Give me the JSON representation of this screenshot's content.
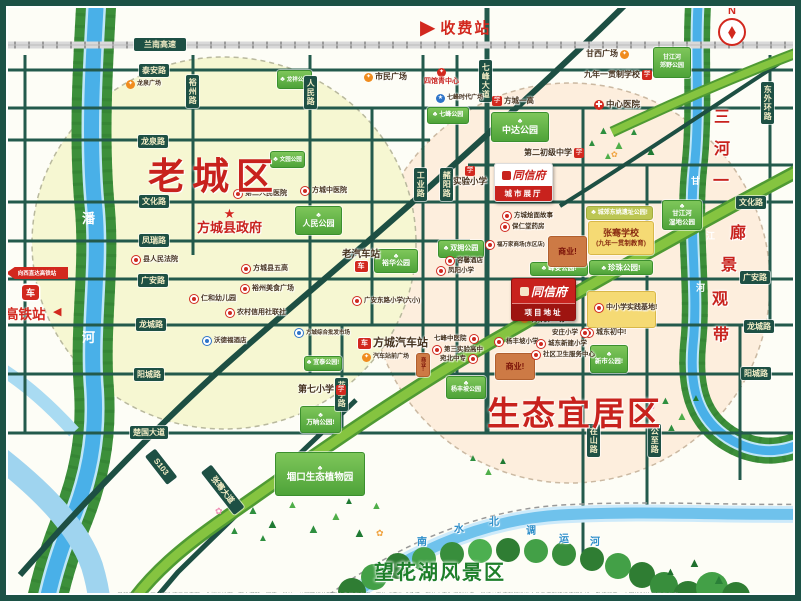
{
  "compass": {
    "label": "N"
  },
  "toll": {
    "label": "收费站"
  },
  "hsr": {
    "banner": "向西直达高铁站",
    "station": "高铁站"
  },
  "zones": {
    "old_town": "老城区",
    "eco": "生态宜居区",
    "scenic": "望花湖风景区"
  },
  "project": {
    "brand": "同信府",
    "showroom": "城市展厅",
    "site": "项目地址"
  },
  "footer": {
    "disclaimer": "温馨提示：本区位图为项目示意图，非标准地图，图中道路、河流、学校、公园等相关配套信息仅供参考，不构成要约或承诺，部分内容为规划信息，最终以政府部门批准文件及实际建设情况为准，敬请留意。本图绘制比例仅供参考。"
  },
  "glyphs": {
    "arrow_right": "▶",
    "arrow_left": "◀",
    "tree": "♣",
    "needle": "◆"
  },
  "icon_glyphs": {
    "school": "学",
    "plaza": "✦",
    "redplaza": "✦",
    "hosp": "✚",
    "bus": "车",
    "blue": "★",
    "train": "车",
    "star": "★",
    "dot": "",
    "bdot": ""
  },
  "road_labels": [
    {
      "id": "lannan-expwy",
      "t": "兰南高速",
      "x": 134,
      "y": 38,
      "w": 46
    },
    {
      "id": "taian-rd",
      "t": "泰安路",
      "x": 139,
      "y": 64
    },
    {
      "id": "longquan-rd",
      "t": "龙泉路",
      "x": 138,
      "y": 135
    },
    {
      "id": "wenhua-rd-l",
      "t": "文化路",
      "x": 139,
      "y": 195
    },
    {
      "id": "fengrui-rd",
      "t": "凤瑞路",
      "x": 139,
      "y": 234
    },
    {
      "id": "guangan-rd-l",
      "t": "广安路",
      "x": 138,
      "y": 274
    },
    {
      "id": "longcheng-rd-l",
      "t": "龙城路",
      "x": 136,
      "y": 318
    },
    {
      "id": "yangcheng-rd-l",
      "t": "阳城路",
      "x": 134,
      "y": 368
    },
    {
      "id": "chuguo-ave",
      "t": "楚国大道",
      "x": 130,
      "y": 426
    },
    {
      "id": "wenhua-rd-r",
      "t": "文化路",
      "x": 736,
      "y": 196
    },
    {
      "id": "guangan-rd-r",
      "t": "广安路",
      "x": 740,
      "y": 271
    },
    {
      "id": "longcheng-rd-r",
      "t": "龙城路",
      "x": 744,
      "y": 320
    },
    {
      "id": "yangcheng-rd-r",
      "t": "阳城路",
      "x": 741,
      "y": 367
    },
    {
      "id": "yuzhou-rd",
      "t": "裕州路",
      "x": 186,
      "y": 75,
      "v": 1
    },
    {
      "id": "renmin-rd",
      "t": "人民路",
      "x": 304,
      "y": 76,
      "v": 1
    },
    {
      "id": "qifeng-ave",
      "t": "七峰大道",
      "x": 479,
      "y": 60,
      "v": 1
    },
    {
      "id": "gongye-rd",
      "t": "工业路",
      "x": 414,
      "y": 168,
      "v": 1
    },
    {
      "id": "zheyang-rd",
      "t": "赭阳路",
      "x": 440,
      "y": 168,
      "v": 1
    },
    {
      "id": "huating-rd",
      "t": "花亭路",
      "x": 335,
      "y": 378,
      "v": 1
    },
    {
      "id": "zaishan-rd",
      "t": "在山路",
      "x": 587,
      "y": 424,
      "v": 1
    },
    {
      "id": "gongzhi-rd",
      "t": "公至路",
      "x": 648,
      "y": 424,
      "v": 1
    },
    {
      "id": "dongwaihuan-rd",
      "t": "东外环路",
      "x": 761,
      "y": 82,
      "v": 1
    },
    {
      "id": "s103",
      "t": "S103",
      "x": 150,
      "y": 446,
      "rot": 52,
      "w": 30
    },
    {
      "id": "zhangqian-ave",
      "t": "张骞大道",
      "x": 206,
      "y": 462,
      "rot": 52,
      "w": 48
    }
  ],
  "parks": [
    {
      "id": "longxiang-park",
      "lines": [
        "龙祥公园"
      ],
      "x": 277,
      "y": 70,
      "w": 33,
      "h": 17,
      "variant": "green",
      "icon": 1,
      "fs": 5.5
    },
    {
      "id": "qifeng-park",
      "lines": [
        "七峰公园"
      ],
      "x": 427,
      "y": 107,
      "w": 40,
      "h": 15,
      "variant": "green",
      "icon": 1,
      "fs": 6
    },
    {
      "id": "wenyuan-park",
      "lines": [
        "文园公园"
      ],
      "x": 270,
      "y": 151,
      "w": 33,
      "h": 15,
      "variant": "green",
      "icon": 1,
      "fs": 5.5
    },
    {
      "id": "renmin-park",
      "lines": [
        "人民公园"
      ],
      "x": 295,
      "y": 206,
      "w": 45,
      "h": 27,
      "variant": "green",
      "icon": 1,
      "icontop": 1,
      "fs": 8
    },
    {
      "id": "zhongda-park",
      "lines": [
        "中达公园"
      ],
      "x": 491,
      "y": 112,
      "w": 56,
      "h": 28,
      "variant": "green",
      "icon": 1,
      "icontop": 1,
      "fs": 9
    },
    {
      "id": "ganjianghe-country-park",
      "lines": [
        "甘江河",
        "郊野公园"
      ],
      "x": 653,
      "y": 47,
      "w": 36,
      "h": 29,
      "variant": "green",
      "fs": 6
    },
    {
      "id": "ganjianghe-wetland-park",
      "lines": [
        "甘江河",
        "湿地公园"
      ],
      "x": 662,
      "y": 200,
      "w": 38,
      "h": 28,
      "variant": "green",
      "icon": 1,
      "icontop": 1,
      "fs": 6.5
    },
    {
      "id": "yuhua-park",
      "lines": [
        "裕华公园"
      ],
      "x": 374,
      "y": 249,
      "w": 42,
      "h": 22,
      "variant": "green",
      "icon": 1,
      "icontop": 1,
      "fs": 7
    },
    {
      "id": "shuangyong-park",
      "lines": [
        "双拥公园"
      ],
      "x": 438,
      "y": 240,
      "w": 44,
      "h": 16,
      "variant": "green",
      "icon": 1,
      "fs": 7
    },
    {
      "id": "fengan-park",
      "lines": [
        "峰安公园!"
      ],
      "x": 530,
      "y": 262,
      "w": 56,
      "h": 12,
      "variant": "green",
      "icon": 1,
      "fs": 6.5
    },
    {
      "id": "zhenzhu-park",
      "lines": [
        "珍珠公园!"
      ],
      "x": 589,
      "y": 260,
      "w": 62,
      "h": 13,
      "variant": "green",
      "icon": 1,
      "fs": 7.5
    },
    {
      "id": "yizhi-park",
      "lines": [
        "城郊东姚遗址公园!"
      ],
      "x": 586,
      "y": 206,
      "w": 65,
      "h": 12,
      "variant": "lime",
      "icon": 1,
      "fs": 6
    },
    {
      "id": "xinshi-park",
      "lines": [
        "新市公园!"
      ],
      "x": 590,
      "y": 345,
      "w": 36,
      "h": 26,
      "variant": "green",
      "icon": 1,
      "icontop": 1,
      "fs": 6.5
    },
    {
      "id": "yitai-park",
      "lines": [
        "宜泰公园!"
      ],
      "x": 304,
      "y": 356,
      "w": 36,
      "h": 13,
      "variant": "green",
      "icon": 1,
      "fs": 6
    },
    {
      "id": "wanshang-park",
      "lines": [
        "万晌公园!"
      ],
      "x": 300,
      "y": 406,
      "w": 39,
      "h": 25,
      "variant": "green",
      "icon": 1,
      "icontop": 1,
      "fs": 6.5
    },
    {
      "id": "gukou-botanical",
      "lines": [
        "堌口生态植物园"
      ],
      "x": 275,
      "y": 452,
      "w": 88,
      "h": 42,
      "variant": "green",
      "icon": 1,
      "icontop": 1,
      "fs": 9.5
    },
    {
      "id": "yangfengpo-park",
      "lines": [
        "杨丰坡公园"
      ],
      "x": 446,
      "y": 376,
      "w": 38,
      "h": 21,
      "variant": "green",
      "icon": 1,
      "icontop": 1,
      "fs": 6
    },
    {
      "id": "zhangqian-school",
      "lines": [
        "张骞学校",
        "(九年一贯制教育)"
      ],
      "x": 588,
      "y": 221,
      "w": 64,
      "h": 32,
      "variant": "yellow",
      "fs": 9,
      "fs2": 6.5
    },
    {
      "id": "practice-base-box",
      "lines": [],
      "x": 587,
      "y": 291,
      "w": 67,
      "h": 35,
      "variant": "yellow"
    },
    {
      "id": "shangye-1",
      "lines": [
        "商业!"
      ],
      "x": 548,
      "y": 236,
      "w": 37,
      "h": 29,
      "variant": "orange",
      "fs": 8
    },
    {
      "id": "shangye-2",
      "lines": [
        "商业!"
      ],
      "x": 495,
      "y": 353,
      "w": 38,
      "h": 25,
      "variant": "orange",
      "fs": 8
    },
    {
      "id": "shangye-3",
      "lines": [
        "商业!"
      ],
      "x": 416,
      "y": 353,
      "w": 12,
      "h": 22,
      "variant": "orange",
      "fs": 5,
      "vert": 1
    }
  ],
  "pois": [
    {
      "id": "longquan-plaza",
      "t": "龙泉广场",
      "type": "plaza",
      "x": 126,
      "y": 80,
      "fs": 6
    },
    {
      "id": "shimin-plaza",
      "t": "市民广场",
      "type": "plaza",
      "x": 364,
      "y": 73,
      "fs": 8
    },
    {
      "id": "ganxi-plaza",
      "t": "甘西广场",
      "type": "plaza",
      "x": 586,
      "y": 50,
      "fs": 8,
      "ip": "r"
    },
    {
      "id": "sports-plaza",
      "t": "体育广场!",
      "type": "plaza",
      "x": 520,
      "y": 314,
      "fs": 8.5
    },
    {
      "id": "bus-front-plaza",
      "t": "汽车站前广场",
      "type": "plaza",
      "x": 362,
      "y": 353,
      "fs": 6
    },
    {
      "id": "qifeng-times-plaza",
      "t": "七峰时代广场",
      "type": "blue",
      "x": 436,
      "y": 94,
      "fs": 6
    },
    {
      "id": "siguanqing-center",
      "t": "四馆青中心",
      "type": "redplaza",
      "x": 424,
      "y": 68,
      "fs": 7,
      "red": 1,
      "ip": "a"
    },
    {
      "id": "fangcheng-yigao",
      "t": "方城一高",
      "type": "school",
      "x": 492,
      "y": 96,
      "fs": 7.5
    },
    {
      "id": "jiunian-school",
      "t": "九年一贯制学校",
      "type": "school",
      "x": 584,
      "y": 70,
      "fs": 8,
      "ip": "r"
    },
    {
      "id": "zhongxin-hospital",
      "t": "中心医院",
      "type": "hosp",
      "x": 594,
      "y": 100,
      "fs": 8.5
    },
    {
      "id": "dier-chuji-middle",
      "t": "第二初级中学",
      "type": "school",
      "x": 524,
      "y": 148,
      "fs": 8,
      "ip": "r"
    },
    {
      "id": "shiyan-primary",
      "t": "实验小学",
      "type": "school",
      "x": 453,
      "y": 166,
      "fs": 8.5,
      "ip": "a"
    },
    {
      "id": "dier-renmin-hospital",
      "t": "第二人民医院",
      "type": "dot",
      "x": 233,
      "y": 189,
      "fs": 7
    },
    {
      "id": "fangcheng-zhongyi",
      "t": "方城中医院",
      "type": "dot",
      "x": 300,
      "y": 186,
      "fs": 7
    },
    {
      "id": "gov",
      "t": "方城县政府",
      "type": "star",
      "x": 197,
      "y": 207,
      "fs": 13,
      "red": 1,
      "ip": "a"
    },
    {
      "id": "renmin-court",
      "t": "县人民法院",
      "type": "dot",
      "x": 131,
      "y": 255,
      "fs": 7
    },
    {
      "id": "renhe-kindergarten",
      "t": "仁和幼儿园",
      "type": "dot",
      "x": 189,
      "y": 294,
      "fs": 7
    },
    {
      "id": "wugao",
      "t": "方城县五高",
      "type": "dot",
      "x": 241,
      "y": 264,
      "fs": 7
    },
    {
      "id": "yuzhou-food",
      "t": "裕州美食广场",
      "type": "dot",
      "x": 240,
      "y": 284,
      "fs": 7
    },
    {
      "id": "rural-credit",
      "t": "农村信用社联社",
      "type": "dot",
      "x": 225,
      "y": 308,
      "fs": 7
    },
    {
      "id": "guangan-primary",
      "t": "广安东路小学(六小)",
      "type": "dot",
      "x": 352,
      "y": 296,
      "fs": 6.5
    },
    {
      "id": "old-bus-station",
      "t": "老汽车站",
      "type": "bus",
      "x": 342,
      "y": 250,
      "fs": 9.5,
      "ip": "b"
    },
    {
      "id": "rongxin-hotel",
      "t": "容馨酒店",
      "type": "dot",
      "x": 445,
      "y": 256,
      "fs": 6.5
    },
    {
      "id": "fengyang-primary",
      "t": "凤阳小学",
      "type": "dot",
      "x": 436,
      "y": 266,
      "fs": 6.5
    },
    {
      "id": "huimian-story",
      "t": "方城烩面故事",
      "type": "dot",
      "x": 502,
      "y": 211,
      "fs": 6.5
    },
    {
      "id": "baorentang",
      "t": "保仁堂药房",
      "type": "dot",
      "x": 500,
      "y": 222,
      "fs": 6.5
    },
    {
      "id": "fuwanjia-mall",
      "t": "福万家商场(东区店)",
      "type": "dot",
      "x": 485,
      "y": 240,
      "fs": 5.5
    },
    {
      "id": "practice-base",
      "t": "中小学实践基地!",
      "type": "dot",
      "x": 594,
      "y": 303,
      "fs": 7
    },
    {
      "id": "chengdong-middle",
      "t": "城东初中!",
      "type": "dot",
      "x": 584,
      "y": 328,
      "fs": 7
    },
    {
      "id": "anzhuang-primary",
      "t": "安庄小学",
      "type": "dot",
      "x": 552,
      "y": 328,
      "fs": 6.5,
      "ip": "r"
    },
    {
      "id": "yangfengpo-primary",
      "t": "杨丰坡小学",
      "type": "dot",
      "x": 494,
      "y": 337,
      "fs": 6.5
    },
    {
      "id": "chengdong-xinjian-primary",
      "t": "城东新建小学",
      "type": "dot",
      "x": 536,
      "y": 339,
      "fs": 6.5
    },
    {
      "id": "shequ-weisheng-center",
      "t": "社区卫生服务中心",
      "type": "dot",
      "x": 531,
      "y": 350,
      "fs": 6.5
    },
    {
      "id": "qifeng-zhongyi",
      "t": "七峰中医院",
      "type": "dot",
      "x": 434,
      "y": 334,
      "fs": 6.5,
      "ip": "r"
    },
    {
      "id": "disan-shiyan-gaozhong",
      "t": "第三实验高中",
      "type": "dot",
      "x": 432,
      "y": 345,
      "fs": 6.5
    },
    {
      "id": "wanbei-zhongzhuan",
      "t": "宛北中专",
      "type": "dot",
      "x": 440,
      "y": 354,
      "fs": 6.5,
      "ip": "r"
    },
    {
      "id": "diqi-primary",
      "t": "第七小学",
      "type": "school",
      "x": 298,
      "y": 385,
      "fs": 9,
      "ip": "r"
    },
    {
      "id": "fangcheng-bus-station",
      "t": "方城汽车站",
      "type": "bus",
      "x": 358,
      "y": 337,
      "fs": 11
    },
    {
      "id": "zonghe-market",
      "t": "方城综合批发市场",
      "type": "bdot",
      "x": 294,
      "y": 328,
      "fs": 5.5
    },
    {
      "id": "wodefu-hotel",
      "t": "沃德福酒店",
      "type": "bdot",
      "x": 202,
      "y": 336,
      "fs": 6.5
    }
  ],
  "char_labels": [
    {
      "id": "corridor-label",
      "color": "#c8221d",
      "fs": 16,
      "halo": 1,
      "items": [
        {
          "c": "三",
          "x": 714,
          "y": 110
        },
        {
          "c": "河",
          "x": 714,
          "y": 142
        },
        {
          "c": "一",
          "x": 713,
          "y": 174
        },
        {
          "c": "廊",
          "x": 730,
          "y": 226
        },
        {
          "c": "景",
          "x": 721,
          "y": 258
        },
        {
          "c": "观",
          "x": 712,
          "y": 292
        },
        {
          "c": "带",
          "x": 713,
          "y": 328
        }
      ]
    },
    {
      "id": "pan-river-label",
      "color": "#ffffff",
      "fs": 13,
      "items": [
        {
          "c": "潘",
          "x": 82,
          "y": 212
        },
        {
          "c": "河",
          "x": 82,
          "y": 331
        }
      ]
    },
    {
      "id": "ganjiang-river-label",
      "color": "#ffffff",
      "fs": 9,
      "items": [
        {
          "c": "甘",
          "x": 691,
          "y": 177
        },
        {
          "c": "江",
          "x": 706,
          "y": 232
        },
        {
          "c": "河",
          "x": 696,
          "y": 284
        }
      ]
    },
    {
      "id": "canal-label",
      "color": "#2f8fc9",
      "fs": 10,
      "halo": 1,
      "items": [
        {
          "c": "南",
          "x": 417,
          "y": 538
        },
        {
          "c": "水",
          "x": 454,
          "y": 525
        },
        {
          "c": "北",
          "x": 489,
          "y": 518
        },
        {
          "c": "调",
          "x": 526,
          "y": 527
        },
        {
          "c": "运",
          "x": 559,
          "y": 535
        },
        {
          "c": "河",
          "x": 590,
          "y": 538
        }
      ]
    }
  ],
  "trees": [
    [
      598,
      126,
      11,
      "#2e8f3f",
      "▲"
    ],
    [
      613,
      139,
      12,
      "#4fae49",
      "▲"
    ],
    [
      629,
      128,
      10,
      "#2e8f3f",
      "▲"
    ],
    [
      645,
      145,
      12,
      "#1f7a33",
      "▲"
    ],
    [
      603,
      152,
      10,
      "#4fae49",
      "▲"
    ],
    [
      587,
      139,
      10,
      "#2e8f3f",
      "▲"
    ],
    [
      660,
      396,
      11,
      "#2e8f3f",
      "▲"
    ],
    [
      676,
      410,
      12,
      "#4fae49",
      "▲"
    ],
    [
      691,
      394,
      10,
      "#1f7a33",
      "▲"
    ],
    [
      666,
      423,
      11,
      "#2e8f3f",
      "▲"
    ],
    [
      468,
      454,
      10,
      "#2e8f3f",
      "▲"
    ],
    [
      483,
      467,
      11,
      "#4fae49",
      "▲"
    ],
    [
      498,
      457,
      10,
      "#1f7a33",
      "▲"
    ],
    [
      247,
      504,
      12,
      "#2e8f3f",
      "▲"
    ],
    [
      266,
      517,
      13,
      "#1f7a33",
      "▲"
    ],
    [
      287,
      500,
      11,
      "#4fae49",
      "▲"
    ],
    [
      307,
      522,
      13,
      "#2e8f3f",
      "▲"
    ],
    [
      330,
      510,
      12,
      "#4fae49",
      "▲"
    ],
    [
      353,
      526,
      13,
      "#1f7a33",
      "▲"
    ],
    [
      229,
      526,
      11,
      "#2e8f3f",
      "▲"
    ],
    [
      371,
      501,
      11,
      "#4fae49",
      "▲"
    ],
    [
      258,
      534,
      10,
      "#2e8f3f",
      "▲"
    ],
    [
      344,
      497,
      10,
      "#1f7a33",
      "▲"
    ],
    [
      688,
      556,
      13,
      "#1f6f2d",
      "▲"
    ],
    [
      712,
      572,
      14,
      "#2a8038",
      "▲"
    ],
    [
      665,
      567,
      11,
      "#1f6f2d",
      "▲"
    ],
    [
      215,
      507,
      9,
      "#ef8fb5",
      "✿"
    ],
    [
      376,
      529,
      9,
      "#f0a13c",
      "✿"
    ],
    [
      648,
      402,
      9,
      "#ef8fb5",
      "✿"
    ],
    [
      611,
      151,
      8,
      "#f0a13c",
      "✿"
    ]
  ]
}
